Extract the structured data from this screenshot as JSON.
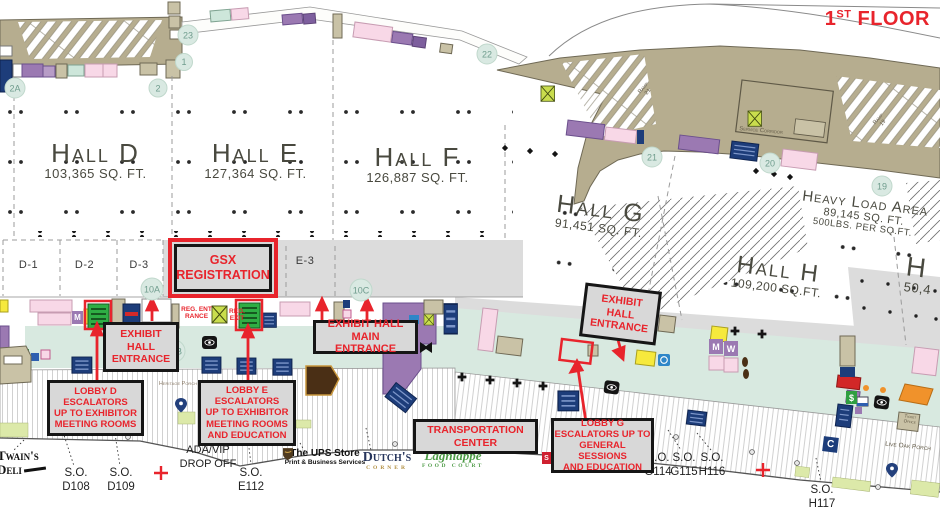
{
  "floor": {
    "num": "1",
    "sup": "ST",
    "word": "FLOOR"
  },
  "halls": {
    "d": {
      "name": "Hall D",
      "sqft": "103,365 SQ. FT."
    },
    "e": {
      "name": "Hall E",
      "sqft": "127,364 SQ. FT."
    },
    "f": {
      "name": "Hall F",
      "sqft": "126,887 SQ. FT."
    },
    "g": {
      "name": "Hall G",
      "sqft": "91,451 SQ. FT."
    },
    "h": {
      "name": "Hall H",
      "sqft": "109,200 SQ.FT."
    },
    "h2": {
      "name": "H",
      "sqft": "50,4"
    }
  },
  "heavy_load": {
    "name": "Heavy Load Area",
    "sqft": "89,145 SQ. FT.",
    "load": "500LBS. PER SQ.FT."
  },
  "zones": {
    "d1": "D-1",
    "d2": "D-2",
    "d3": "D-3",
    "e3": "E-3"
  },
  "badges": {
    "n23": "23",
    "n1": "1",
    "n2": "2",
    "n2a": "2A",
    "n22": "22",
    "n21": "21",
    "n20": "20",
    "n19": "19",
    "n10a": "10A",
    "n10b": "10B",
    "n10c": "10C"
  },
  "callouts": {
    "gsx": "GSX\nREGISTRATION",
    "exhibit_d": "EXHIBIT\nHALL\nENTRANCE",
    "exhibit_main": "EXHIBIT HALL MAIN\nENTRANCE",
    "exhibit_g": "EXHIBIT\nHALL\nENTRANCE",
    "lobby_d": "LOBBY D\nESCALATORS\nUP TO EXHIBITOR\nMEETING ROOMS",
    "lobby_e": "LOBBY E\nESCALATORS\nUP TO EXHIBITOR\nMEETING ROOMS\nAND EDUCATION",
    "transportation": "TRANSPORTATION\nCENTER",
    "lobby_g": "LOBBY G\nESCALATORS UP TO\nGENERAL SESSIONS\nAND EDUCATION",
    "reg_entrance": "REG. ENTRANCE",
    "reg_exit": "REG. EXIT"
  },
  "labels": {
    "service_corridor": "Service Corridor",
    "ramp21": "Ramp 21",
    "ramp19": "Ramp 19",
    "heritage_porch": "Heritage Porch",
    "live_oak_porch": "Live Oak Porch",
    "ada_vip": "ADA/VIP\nDROP OFF",
    "ticket_office": "Ticket\nOffice"
  },
  "service_offices": {
    "prefix": "S.O.",
    "d108": "D108",
    "d109": "D109",
    "e112": "E112",
    "g114": "G114",
    "g115": "G115",
    "h116": "H116",
    "h117": "H117"
  },
  "vendors": {
    "twains_line1": "Twain's",
    "twains_line2": "Deli",
    "ups_name": "The UPS Store",
    "ups_sub": "Print & Business Services",
    "dutchs_name": "Dutch's",
    "dutchs_sub": "CORNER",
    "lagniappe_name": "Lagniappe",
    "lagniappe_sub": "FOOD COURT"
  },
  "icons": {
    "mens": "M",
    "womens": "W",
    "concessions": "C",
    "atm": "$",
    "shuttle": "S"
  },
  "colors": {
    "accent_red": "#e8242c",
    "concourse_mint": "#d8e9e0",
    "concourse_gray": "#dcdcdc",
    "dock_tan": "#b6ad8f",
    "highlight_green": "#2fae44"
  }
}
